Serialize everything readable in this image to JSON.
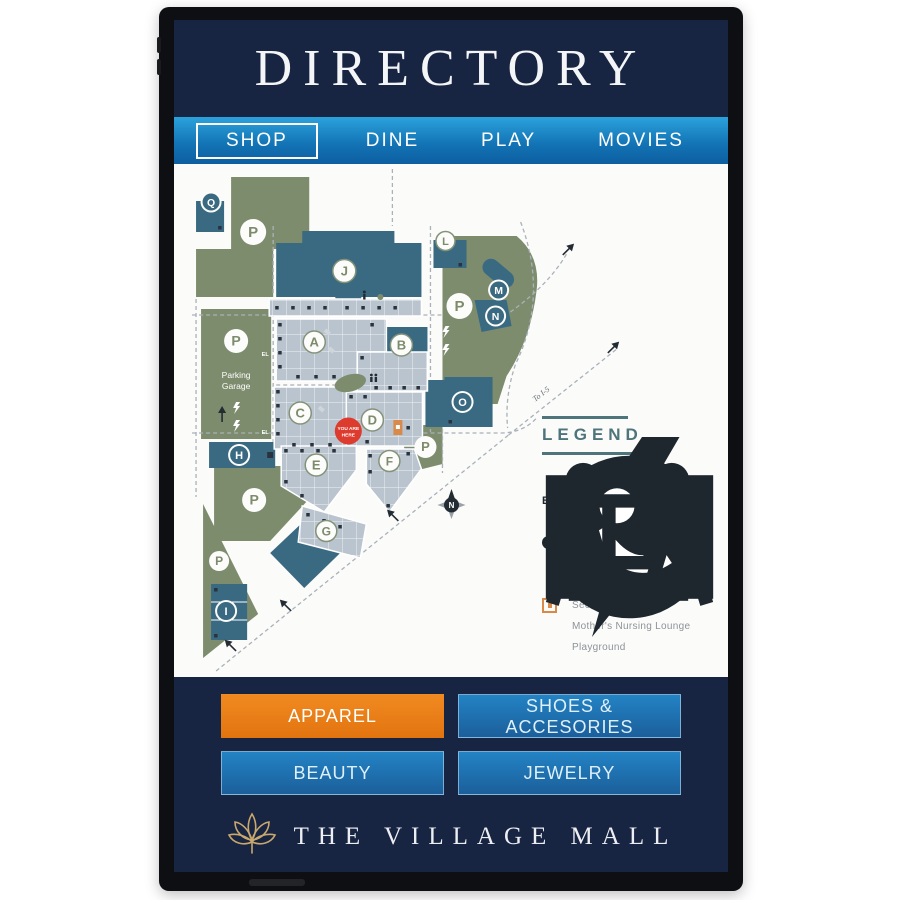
{
  "header": {
    "title": "DIRECTORY"
  },
  "nav": {
    "items": [
      {
        "label": "SHOP",
        "selected": true
      },
      {
        "label": "DINE",
        "selected": false
      },
      {
        "label": "PLAY",
        "selected": false
      },
      {
        "label": "MOVIES",
        "selected": false
      }
    ]
  },
  "map": {
    "you_are_here_line1": "YOU ARE",
    "you_are_here_line2": "HERE",
    "parking_garage_line1": "Parking",
    "parking_garage_line2": "Garage",
    "to_i5_label": "To I-5",
    "compass_label": "N",
    "parking_letter": "P",
    "elevator_label": "EL",
    "buildings": [
      {
        "label": "A"
      },
      {
        "label": "B"
      },
      {
        "label": "C"
      },
      {
        "label": "D"
      },
      {
        "label": "E"
      },
      {
        "label": "F"
      },
      {
        "label": "G"
      },
      {
        "label": "H"
      },
      {
        "label": "I"
      },
      {
        "label": "J"
      },
      {
        "label": "L"
      },
      {
        "label": "M"
      },
      {
        "label": "N"
      },
      {
        "label": "O"
      },
      {
        "label": "Q"
      }
    ]
  },
  "legend": {
    "title": "LEGEND",
    "items": [
      {
        "icon": "entrance-arrow",
        "label": "Entrance"
      },
      {
        "icon": "elevator",
        "label": "Elevator",
        "icon_text": "EL"
      },
      {
        "icon": "lightning-bolt",
        "label": "EV Charging Station"
      },
      {
        "icon": "parking-circle",
        "label": "Parking",
        "icon_text": "P"
      },
      {
        "icon": "restroom-figures",
        "label": "Public/Family Restrooms"
      },
      {
        "icon": "envelope",
        "label": "Mailbox"
      },
      {
        "icon": "security-square",
        "label": "Security"
      },
      {
        "icon": "nursing-lounge",
        "label": "Mother's Nursing Lounge"
      },
      {
        "icon": "playground-swings",
        "label": "Playground"
      }
    ]
  },
  "categories": [
    {
      "label": "APPAREL",
      "selected": true
    },
    {
      "label": "SHOES & ACCESORIES",
      "selected": false
    },
    {
      "label": "BEAUTY",
      "selected": false
    },
    {
      "label": "JEWELRY",
      "selected": false
    }
  ],
  "footer": {
    "brand": "THE VILLAGE MALL"
  },
  "colors": {
    "screen_navy": "#172442",
    "nav_blue_top": "#2ba2dc",
    "nav_blue_bottom": "#0d5fa0",
    "accent_orange": "#ea7c15",
    "map_green": "#7e8c6e",
    "map_teal": "#3a6a82",
    "map_units": "#b9c4ce",
    "alert_red": "#de3b2f",
    "legend_teal": "#4e747c",
    "brand_gold": "#c9a86d"
  }
}
